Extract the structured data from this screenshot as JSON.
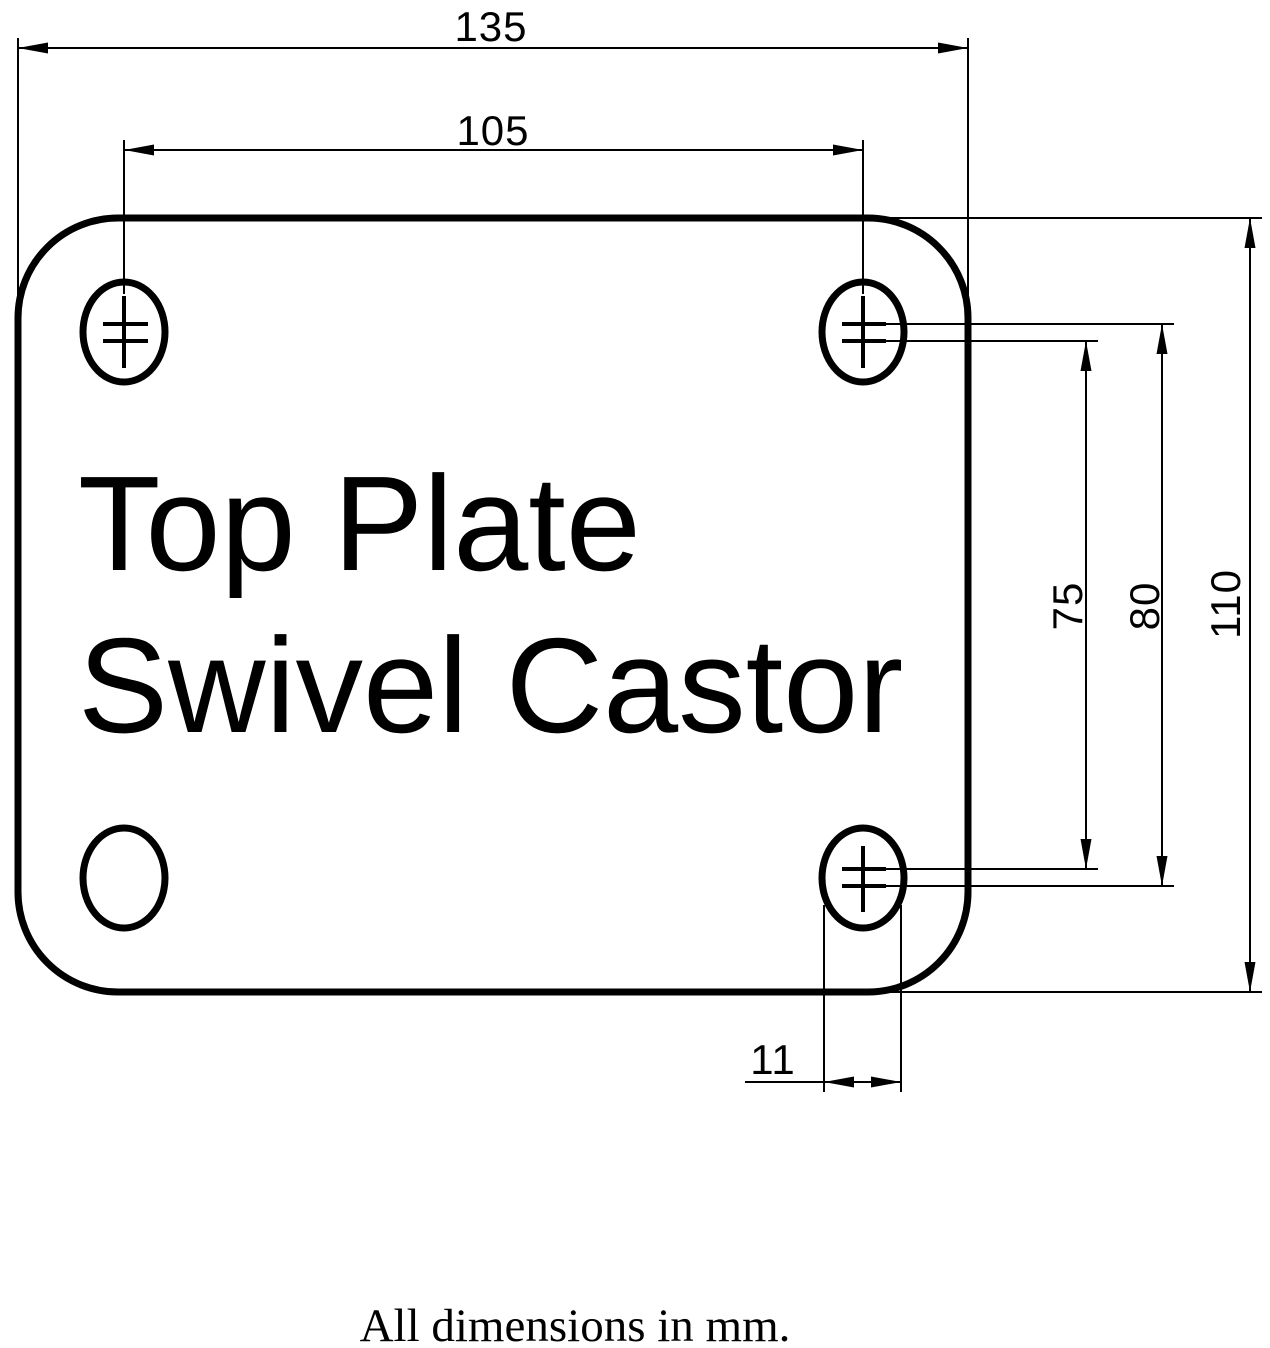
{
  "title": {
    "line1": "Top Plate",
    "line2": "Swivel Castor"
  },
  "footer": {
    "note": "All dimensions in mm."
  },
  "dimensions": {
    "plate_width_mm": "135",
    "hole_pitch_x_mm": "105",
    "hole_pitch_inner_mm": "75",
    "hole_pitch_outer_mm": "80",
    "plate_height_mm": "110",
    "slot_width_mm": "11"
  },
  "colors": {
    "line": "#000000",
    "background": "#ffffff"
  }
}
